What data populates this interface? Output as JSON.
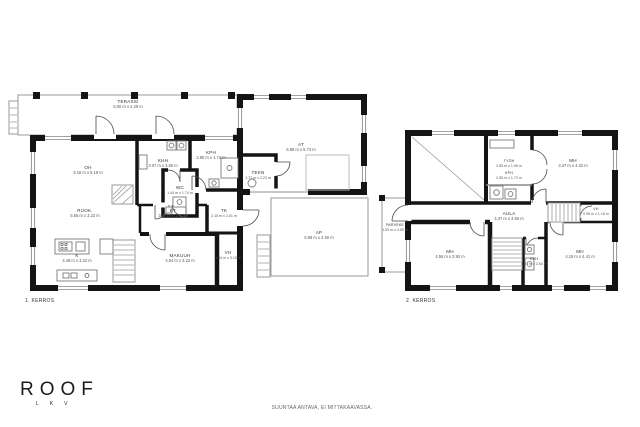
{
  "meta": {
    "disclaimer": "SUUNTAA ANTAVA, EI MITTAKAAVASSA."
  },
  "logo": {
    "text": "ROOF",
    "sub": "LKV"
  },
  "colors": {
    "wall": "#141414",
    "line": "#8a8a8a",
    "text": "#3a3a3a"
  },
  "floor1": {
    "label": "1. KERROS",
    "rooms": {
      "terassi": {
        "name": "TERASSI",
        "dims": "5.00 m x 2.28 m"
      },
      "oh": {
        "name": "OH",
        "dims": "5.18 m x 5.18 m"
      },
      "khh": {
        "name": "KHH",
        "dims": "3.07 m x 3.65 m"
      },
      "kph": {
        "name": "KPH",
        "dims": "2.80 m x 1.72 m"
      },
      "wc": {
        "name": "WC",
        "dims": "1.44 m x 1.74 m"
      },
      "ruok": {
        "name": "RUOK.",
        "dims": "5.55 m x 3.22 m"
      },
      "et": {
        "name": "ET",
        "dims": "3.37 m x 1.82 m"
      },
      "tk": {
        "name": "TK",
        "dims": "2.15 m x 2.01 m"
      },
      "makuuh": {
        "name": "MAKUUH",
        "dims": "4.04 m x 3.22 m"
      },
      "vh": {
        "name": "VH",
        "dims": "1.44 m x 3.15 m"
      },
      "k": {
        "name": "K",
        "dims": "4.49 m x 3.22 m"
      },
      "at": {
        "name": "AT",
        "dims": "6.89 m x 5.74 m"
      },
      "tekn": {
        "name": "TEKN",
        "dims": "1.72 m x 2.23 m"
      },
      "ap": {
        "name": "AP",
        "dims": "6.59 m x 2.50 m"
      }
    }
  },
  "floor2": {
    "label": "2. KERROS",
    "rooms": {
      "parveke": {
        "name": "PARVEKE",
        "dims": "1.53 m x 4.09 m"
      },
      "tyoh": {
        "name": "TYÖH",
        "dims": "2.55 m x 1.95 m"
      },
      "kph": {
        "name": "KPH",
        "dims": "2.55 m x 1.72 m"
      },
      "mh1": {
        "name": "MH",
        "dims": "3.37 m x 4.32 m"
      },
      "aula": {
        "name": "AULA",
        "dims": "4.37 m x 3.55 m"
      },
      "vh": {
        "name": "VH",
        "dims": "0.95 m x 1.15 m"
      },
      "mh2": {
        "name": "MH",
        "dims": "4.56 m x 3.92 m"
      },
      "kph2": {
        "name": "KPH",
        "dims": "1.07 m x 2.64 m"
      },
      "mh3": {
        "name": "MH",
        "dims": "4.19 m x 4.41 m"
      }
    }
  }
}
